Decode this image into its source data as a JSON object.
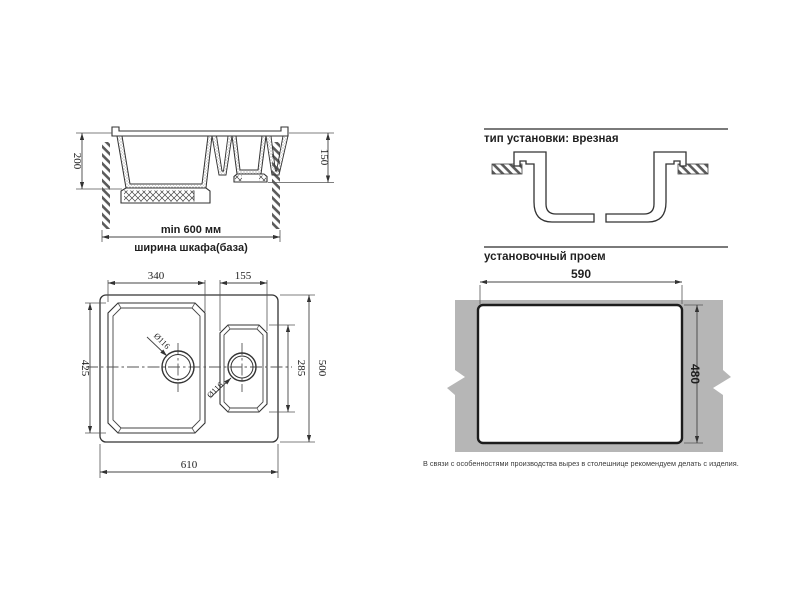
{
  "front_view": {
    "dim_depth_main_bowl": "200",
    "dim_depth_small_bowl": "150",
    "dim_min_cabinet_width": "min 600 мм",
    "cabinet_width_label": "ширина шкафа(база)"
  },
  "install_type": {
    "title": "тип установки: врезная"
  },
  "top_view": {
    "dim_main_bowl_width": "340",
    "dim_small_bowl_width": "155",
    "dim_main_bowl_length": "425",
    "dim_small_bowl_length": "285",
    "dim_overall_length": "500",
    "dim_overall_width": "610",
    "dim_drain_main": "Ø116",
    "dim_drain_small": "Ø116"
  },
  "cutout_section": {
    "title": "установочный проем",
    "dim_cutout_width": "590",
    "dim_cutout_height": "480",
    "note": "В связи с особенностями производства вырез в столешнице рекомендуем делать с изделия.",
    "countertop_color": "#b6b6b6",
    "cutout_border_color": "#1c1c1c"
  },
  "colors": {
    "line": "#333333",
    "text": "#1f1f1f",
    "background": "#ffffff"
  }
}
